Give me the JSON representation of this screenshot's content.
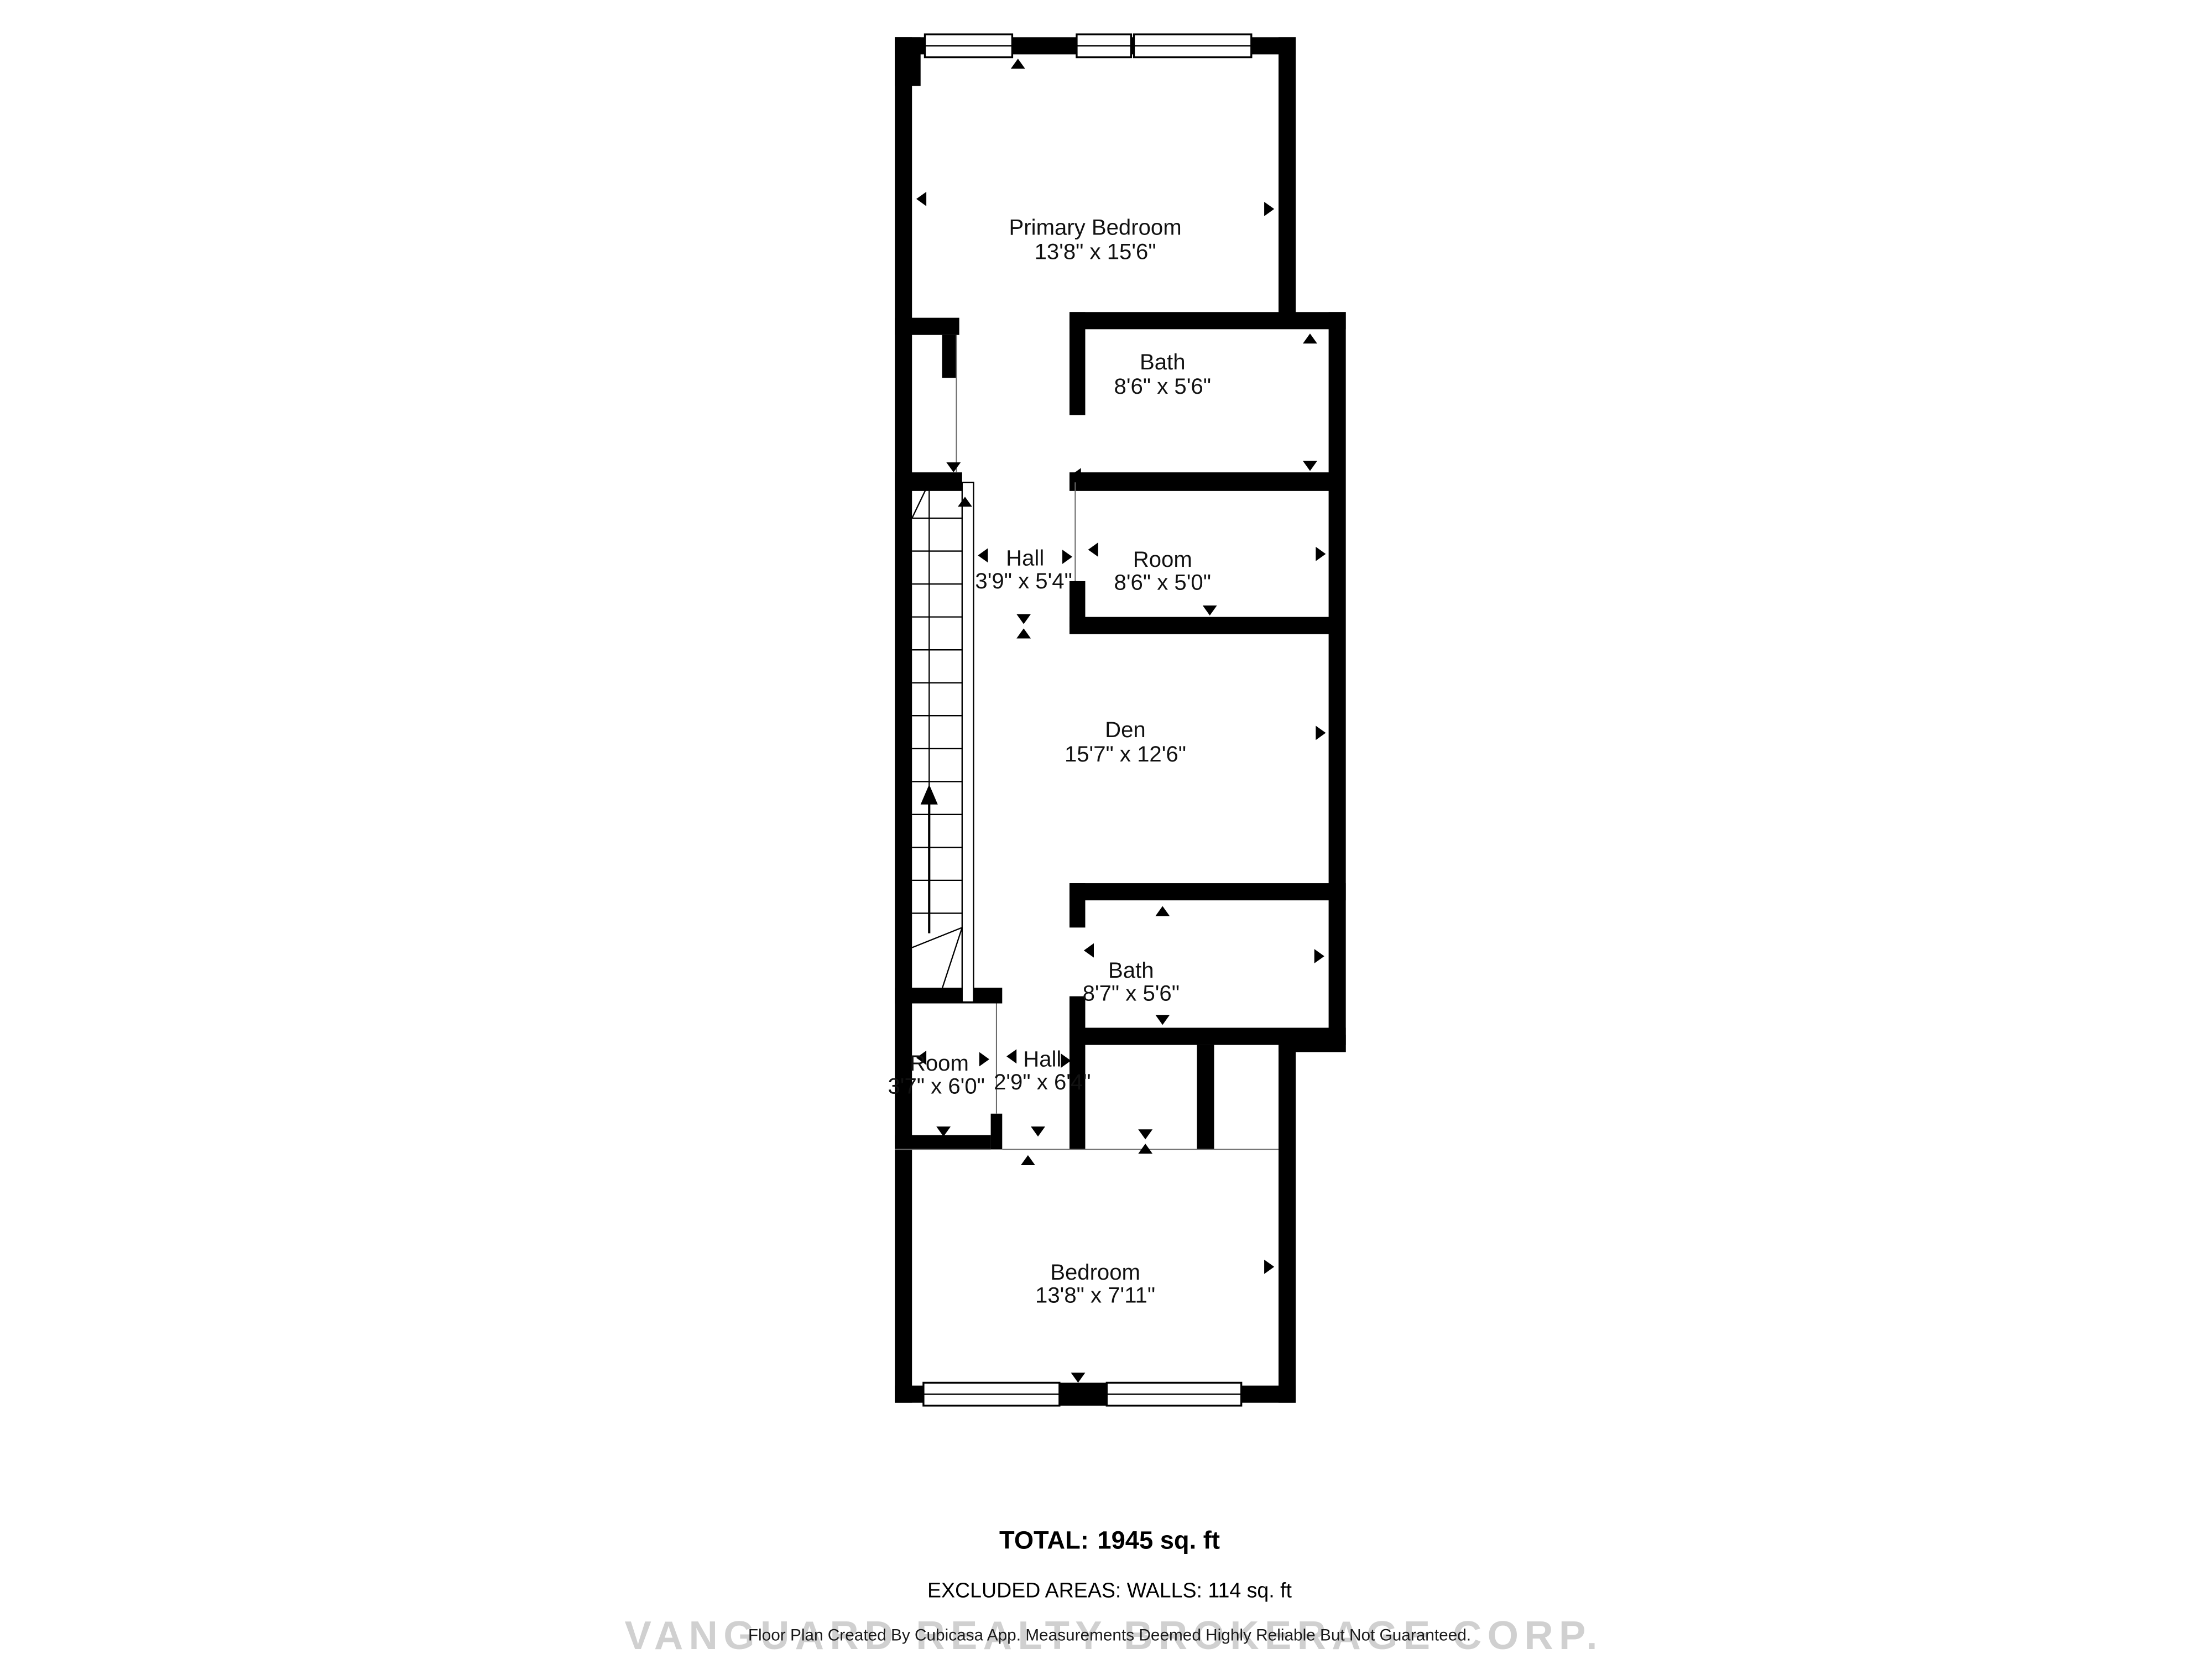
{
  "rooms": [
    {
      "name": "Primary Bedroom",
      "dims": "13'8\" x 15'6\""
    },
    {
      "name": "Bath",
      "dims": "8'6\" x 5'6\""
    },
    {
      "name": "Hall",
      "dims": "3'9\" x 5'4\""
    },
    {
      "name": "Room",
      "dims": "8'6\" x 5'0\""
    },
    {
      "name": "Den",
      "dims": "15'7\" x 12'6\""
    },
    {
      "name": "Bath",
      "dims": "8'7\" x 5'6\""
    },
    {
      "name": "Room",
      "dims": "3'7\" x 6'0\""
    },
    {
      "name": "Hall",
      "dims": "2'9\" x 6'4\""
    },
    {
      "name": "Bedroom",
      "dims": "13'8\" x 7'11\""
    }
  ],
  "summary": {
    "total_label": "TOTAL:",
    "total_value": "1945  sq. ft",
    "excluded_line": "EXCLUDED AREAS: WALLS: 114 sq. ft",
    "disclaimer": "Floor Plan Created By Cubicasa App. Measurements Deemed Highly Reliable But Not Guaranteed.",
    "watermark": "VANGUARD REALTY BROKERAGE CORP."
  },
  "colors": {
    "walls": "#000000",
    "background": "#ffffff",
    "watermark": "#cbcbcb"
  }
}
